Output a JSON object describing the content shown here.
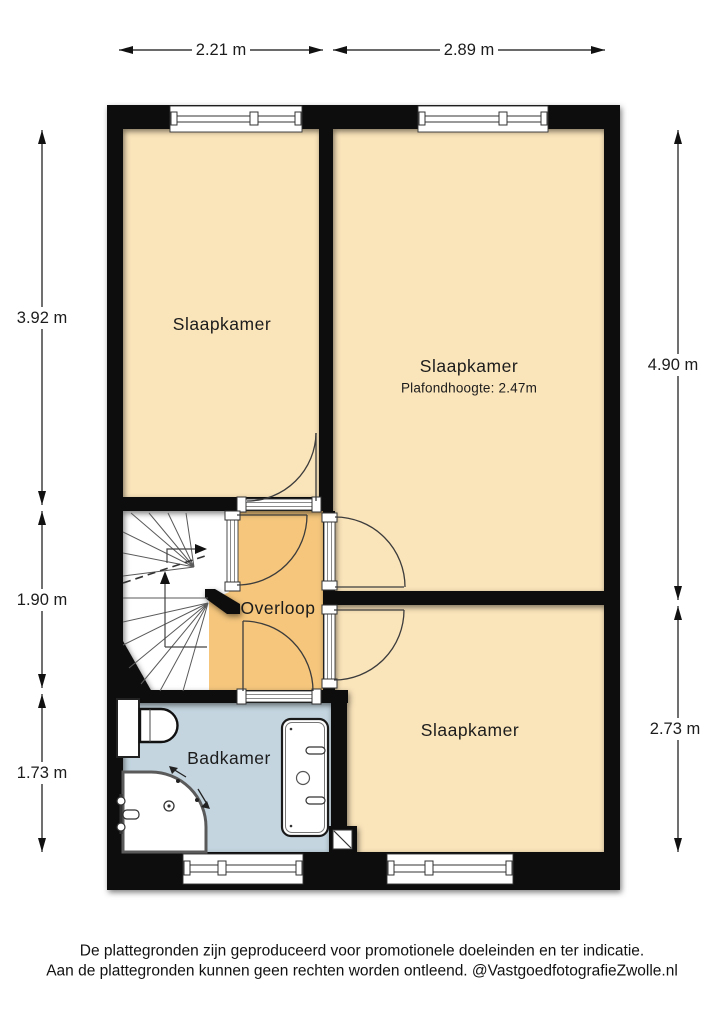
{
  "plan": {
    "rooms": [
      {
        "id": "bedroom-1",
        "label": "Slaapkamer"
      },
      {
        "id": "bedroom-2",
        "label": "Slaapkamer",
        "ceiling_note": "Plafondhoogte: 2.47m"
      },
      {
        "id": "landing",
        "label": "Overloop"
      },
      {
        "id": "bathroom",
        "label": "Badkamer"
      },
      {
        "id": "bedroom-3",
        "label": "Slaapkamer"
      }
    ],
    "dimensions": {
      "top_left_width": "2.21 m",
      "top_right_width": "2.89 m",
      "left_upper_height": "3.92 m",
      "left_middle_height": "1.90 m",
      "left_lower_height": "1.73 m",
      "right_upper_height": "4.90 m",
      "right_lower_height": "2.73 m"
    },
    "colors": {
      "room_fill": "#fae4ba",
      "landing_fill": "#f5c67c",
      "bathroom_fill": "#c4d5e0",
      "wall": "#0d0d0d",
      "background": "#ffffff"
    },
    "footer": {
      "line1": "De plattegronden zijn geproduceerd voor promotionele doeleinden en ter indicatie.",
      "line2": "Aan de plattegronden kunnen geen rechten worden ontleend. @VastgoedfotografieZwolle.nl"
    }
  }
}
